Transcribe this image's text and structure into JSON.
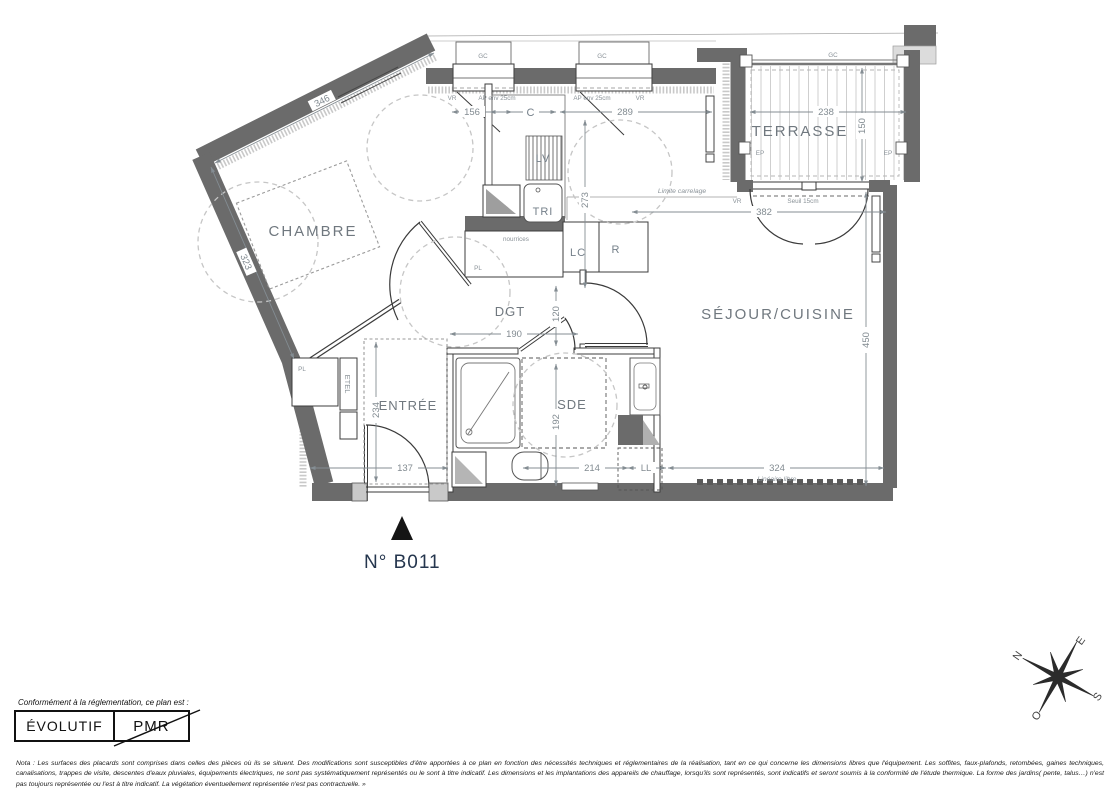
{
  "plan": {
    "unit_number": "N° B011",
    "rooms": {
      "chambre": "CHAMBRE",
      "terrasse": "TERRASSE",
      "sejour": "SÉJOUR/CUISINE",
      "entree": "ENTRÉE",
      "sde": "SDE",
      "dgt": "DGT"
    },
    "dims": {
      "d346": "346",
      "d323": "323",
      "d156": "156",
      "d289": "289",
      "d273": "273",
      "d238": "238",
      "d150": "150",
      "d382": "382",
      "d450": "450",
      "d190": "190",
      "d120": "120",
      "d234": "234",
      "d137": "137",
      "d192": "192",
      "d214": "214",
      "d324": "324"
    },
    "labels": {
      "gc": "GC",
      "vr": "VR",
      "ap25": "AP env 25cm",
      "ep": "EP",
      "seuil": "Seuil 15cm",
      "limite_carrelage": "Limite carrelage",
      "lineaire_libre": "Linéaire libre",
      "nourrices": "nourrices",
      "pl": "PL",
      "etel": "ETEL",
      "lv": "LV",
      "tri": "TRI",
      "lc": "LC",
      "r": "R",
      "c": "C",
      "ll": "LL"
    },
    "compass": {
      "n": "N",
      "e": "E",
      "s": "S",
      "o": "O"
    }
  },
  "legend": {
    "intro": "Conformément à la réglementation, ce plan est :",
    "evolutif": "ÉVOLUTIF",
    "pmr": "PMR"
  },
  "nota": "Nota : Les surfaces des placards sont comprises dans celles des pièces où ils se situent. Des modifications sont susceptibles d'être apportées à ce plan en fonction des nécessités techniques et réglementaires de la réalisation, tant en ce qui concerne les dimensions libres que l'équipement.  Les soffites, faux-plafonds, retombées, gaines techniques, canalisations, trappes de visite, descentes d'eaux pluviales, équipements électriques, ne sont pas systématiquement représentés ou le sont à titre indicatif. Les dimensions et les implantations des appareils de chauffage, lorsqu'ils sont représentés, sont indicatifs et seront soumis à la conformité de l'étude thermique. La forme des jardins( pente, talus…) n'est pas toujours représentée ou l'est à titre indicatif. La végétation éventuellement représentée n'est pas contractuelle. »"
}
